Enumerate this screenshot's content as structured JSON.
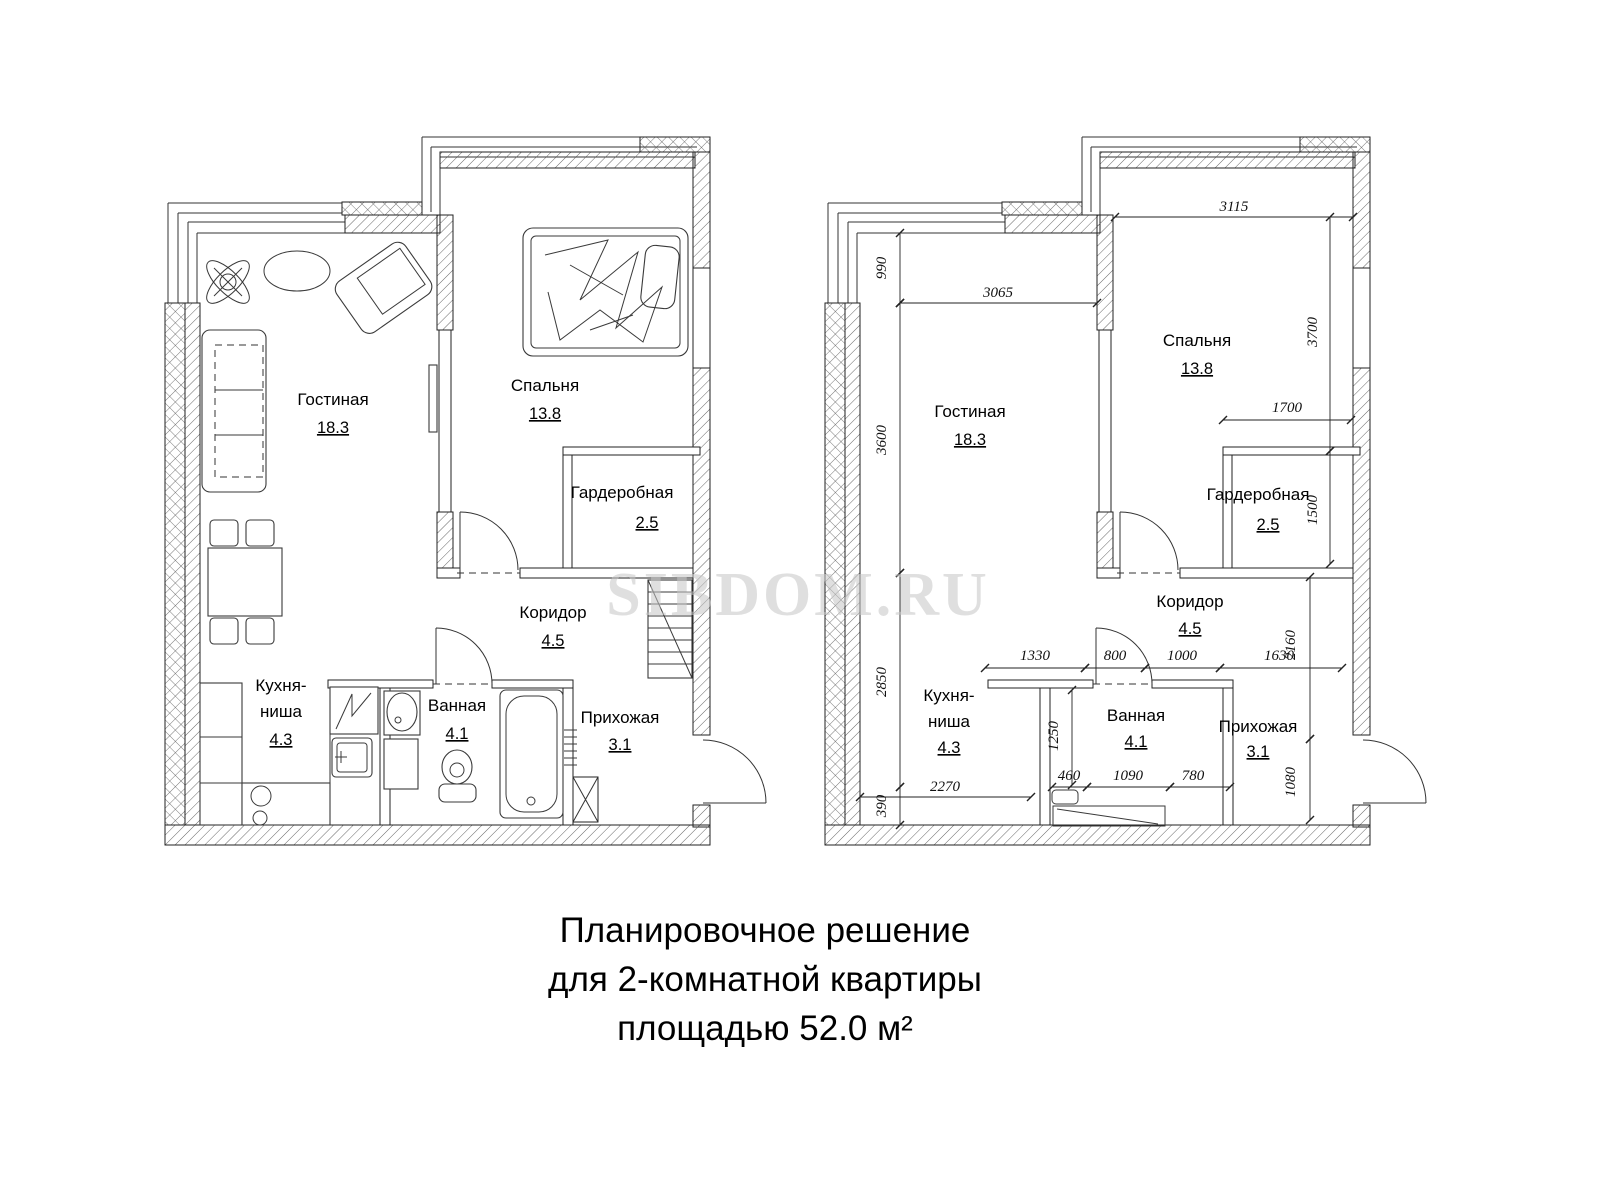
{
  "watermark": "SIBDOM.RU",
  "caption": {
    "line1": "Планировочное решение",
    "line2": "для 2-комнатной квартиры",
    "line3": "площадью 52.0 м²"
  },
  "rooms": [
    {
      "name": "Гостиная",
      "area": "18.3"
    },
    {
      "name": "Спальня",
      "area": "13.8"
    },
    {
      "name": "Гардеробная",
      "area": "2.5"
    },
    {
      "name": "Коридор",
      "area": "4.5"
    },
    {
      "name_line1": "Кухня-",
      "name_line2": "ниша",
      "area": "4.3"
    },
    {
      "name": "Ванная",
      "area": "4.1"
    },
    {
      "name": "Прихожая",
      "area": "3.1"
    }
  ],
  "dimensions": [
    "3115",
    "990",
    "3065",
    "3700",
    "3600",
    "1700",
    "1500",
    "2850",
    "1330",
    "800",
    "1000",
    "1630",
    "2160",
    "1250",
    "460",
    "1090",
    "780",
    "2270",
    "390",
    "1080"
  ]
}
